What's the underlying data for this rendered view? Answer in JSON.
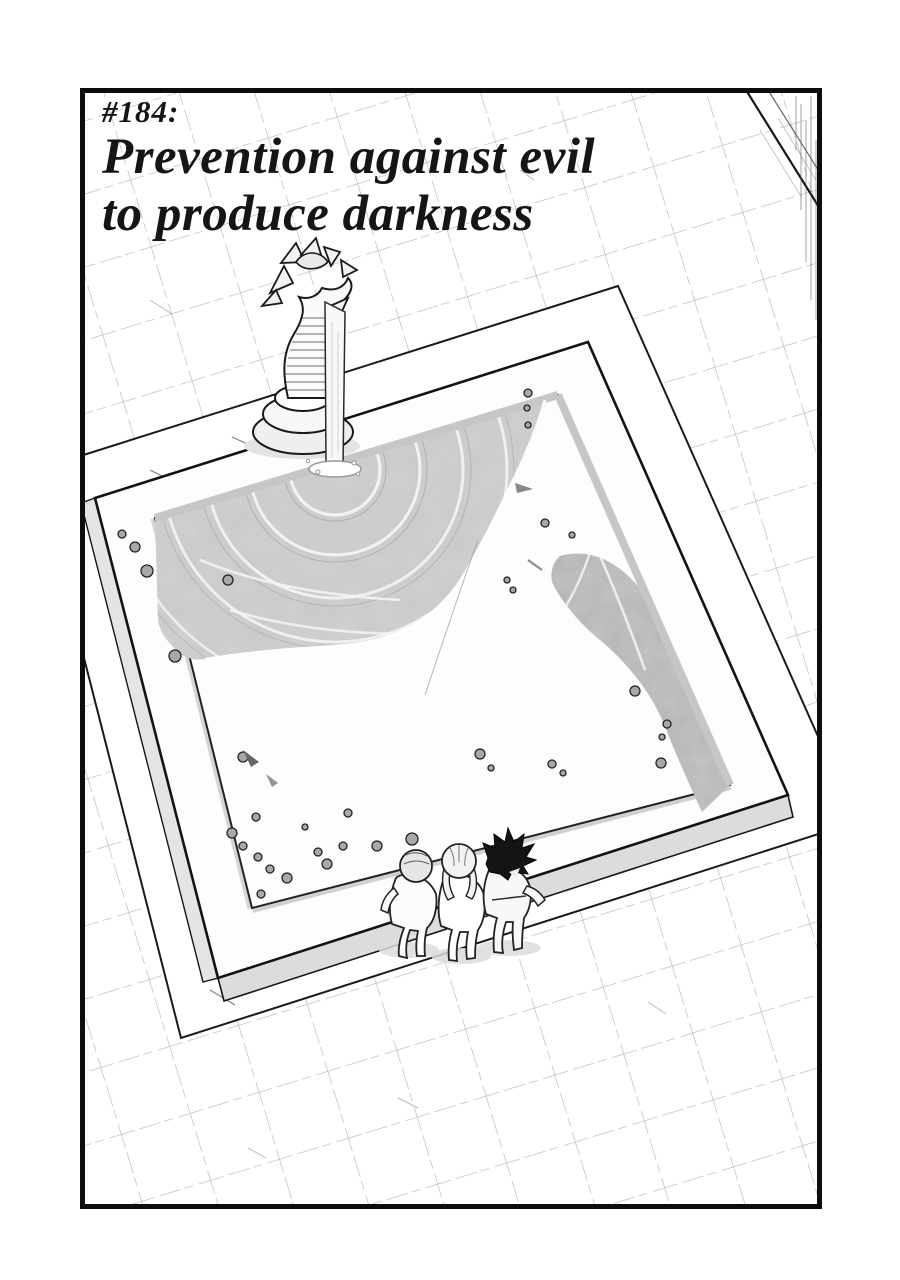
{
  "title": {
    "chapter_number": "#184:",
    "line_1": "Prevention against evil",
    "line_2": "to produce darkness"
  },
  "illustration": {
    "description": "Overhead manga view of a tiled courtyard with a square fountain pool; a serpent statue on a round pedestal pours a jet of water into the rippling pool, and three figures stand on the near rim looking into the basin scattered with pebbles.",
    "elements": [
      "tiled-floor",
      "walkway",
      "fountain-pool",
      "pool-rim",
      "pool-water",
      "water-ripples",
      "pebbles",
      "serpent-statue",
      "pedestal",
      "water-jet",
      "splash",
      "onlooker-left",
      "onlooker-middle",
      "onlooker-right",
      "wall-corner-sketch",
      "panel-border"
    ]
  },
  "palette": {
    "ink": "#141414",
    "paper": "#ffffff",
    "water": "#c9c9c9",
    "water_shadow": "#b3b3b3",
    "stone_shade": "#dedede"
  }
}
